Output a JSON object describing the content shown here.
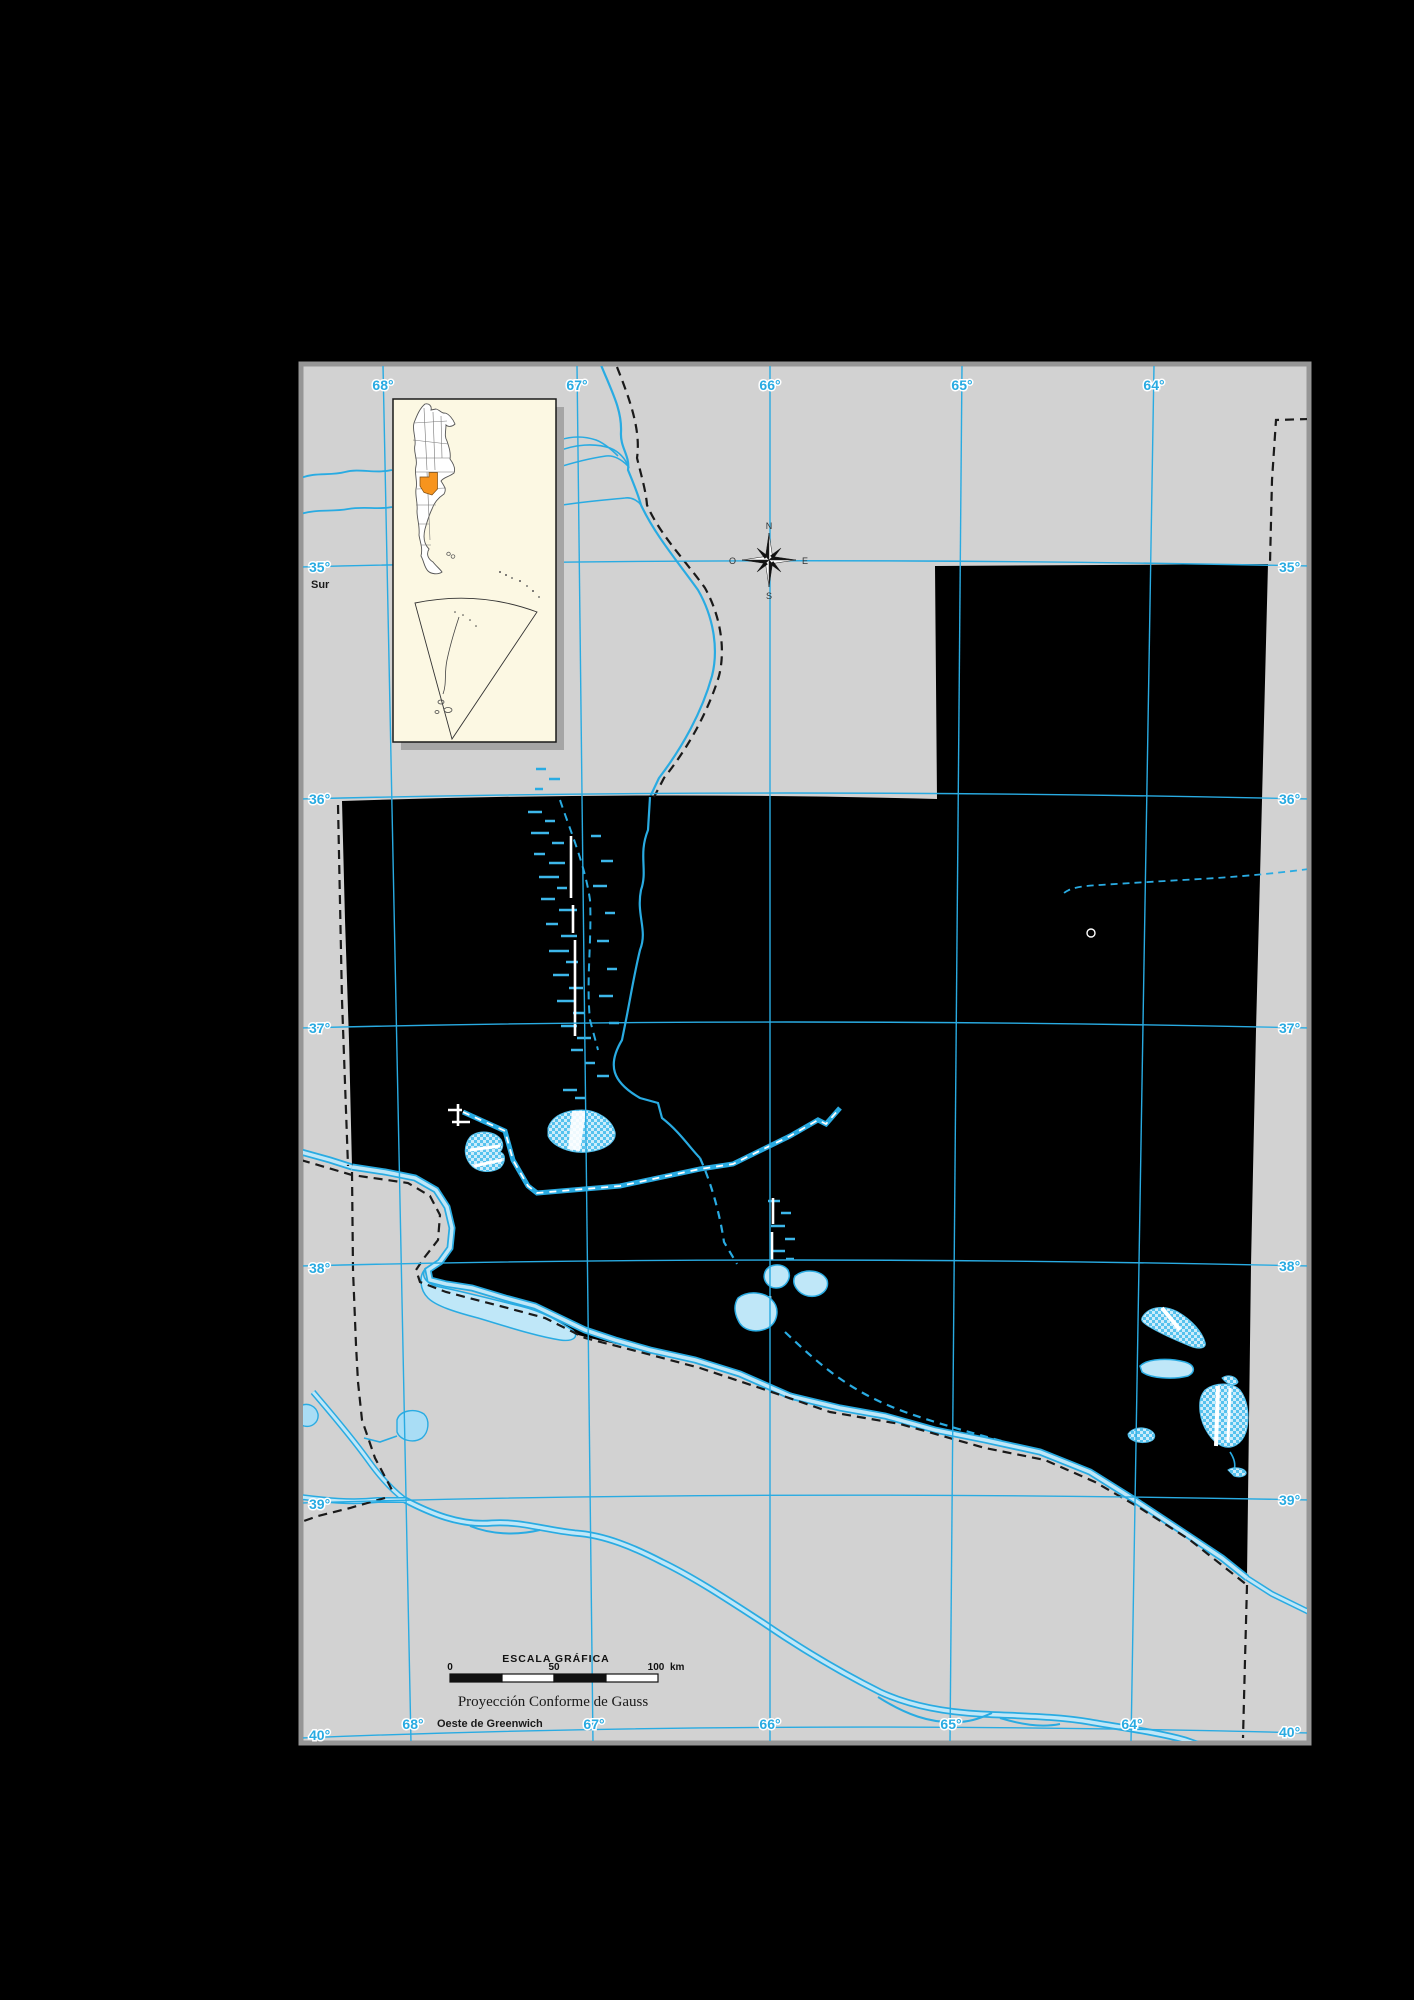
{
  "map": {
    "paper_color": "#d2d2d2",
    "frame_color": "#969696",
    "grid_color": "#29abe2",
    "water_color": "#29abe2",
    "water_fill": "#bfe7f8",
    "province_fill": "#000000",
    "boundary_color": "#1a1a1a",
    "inset_bg": "#fcf8e3",
    "inset_highlight": "#f7941e",
    "top_longitudes": [
      "68°",
      "67°",
      "66°",
      "65°",
      "64°"
    ],
    "bottom_longitudes": [
      "68°",
      "67°",
      "66°",
      "65°",
      "64°"
    ],
    "left_latitudes": [
      "35°",
      "36°",
      "37°",
      "38°",
      "39°",
      "40°"
    ],
    "right_latitudes": [
      "35°",
      "36°",
      "37°",
      "38°",
      "39°",
      "40°"
    ],
    "south_label": "Sur",
    "west_label": "Oeste de Greenwich"
  },
  "compass": {
    "n": "N",
    "e": "E",
    "s": "S",
    "o": "O"
  },
  "scale_bar": {
    "title": "ESCALA GRÁFICA",
    "tick_0": "0",
    "tick_50": "50",
    "tick_100": "100",
    "unit": "km"
  },
  "projection_label": "Proyección Conforme de Gauss"
}
